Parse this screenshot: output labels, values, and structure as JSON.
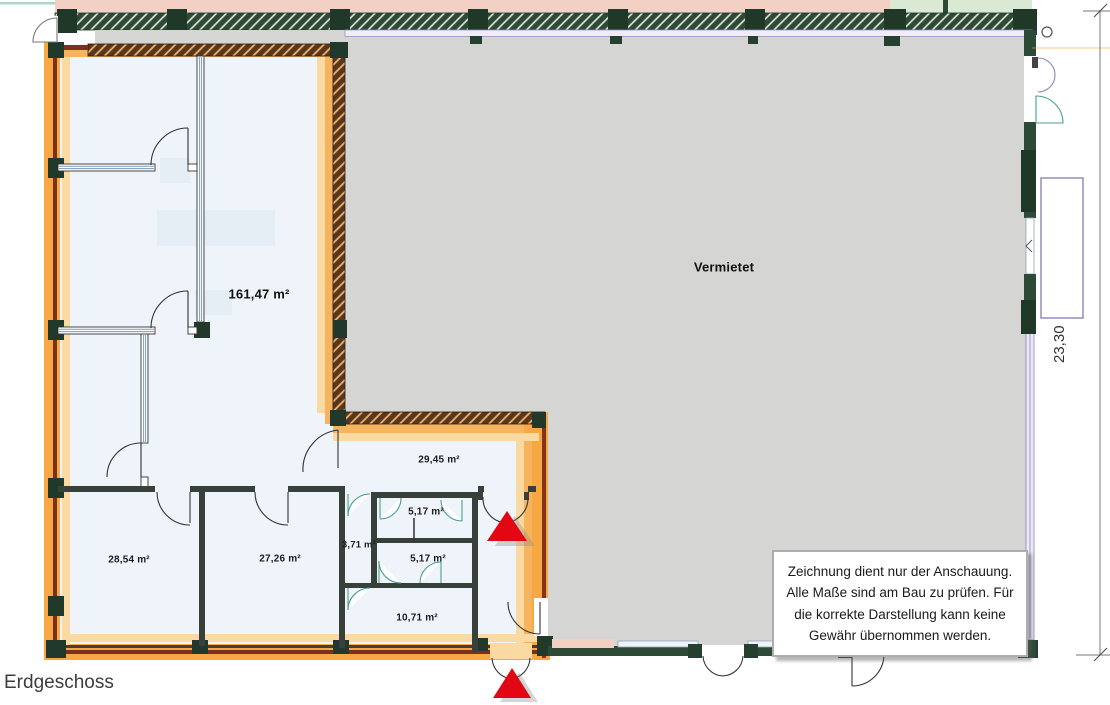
{
  "meta": {
    "floor_label": "Erdgeschoss"
  },
  "areas": {
    "vermietet": {
      "label": "Vermietet"
    },
    "unit": {
      "main": "161,47 m²",
      "hall": "29,45 m²",
      "room_a": "28,54 m²",
      "room_b": "27,26 m²",
      "niche": "3,71 m²",
      "wc_upper": "5,17 m²",
      "wc_lower": "5,17 m²",
      "storage": "10,71 m²"
    }
  },
  "dimension": {
    "right_side": "23,30"
  },
  "disclaimer": {
    "text": "Zeichnung dient nur der Anschauung. Alle Maße sind am Bau zu prüfen. Für die korrekte Darstellung kann keine Gewähr übernommen werden."
  },
  "icons": {
    "entrance_marker": "red-triangle-arrow"
  },
  "colors": {
    "highlight_orange": "#f7a843",
    "wall_dark_green": "#2c4a36",
    "vermietet_gray": "#d5d5d3",
    "unit_fill": "#eef4f9",
    "entrance_red": "#e30613",
    "outside_pink": "#f2d0c3",
    "outside_green": "#d9e9d4",
    "window_purple": "#8f84b8",
    "door_teal": "#4aa08e",
    "wall_maroon": "#7a3020",
    "partition_blue": "#7b9cc0"
  }
}
